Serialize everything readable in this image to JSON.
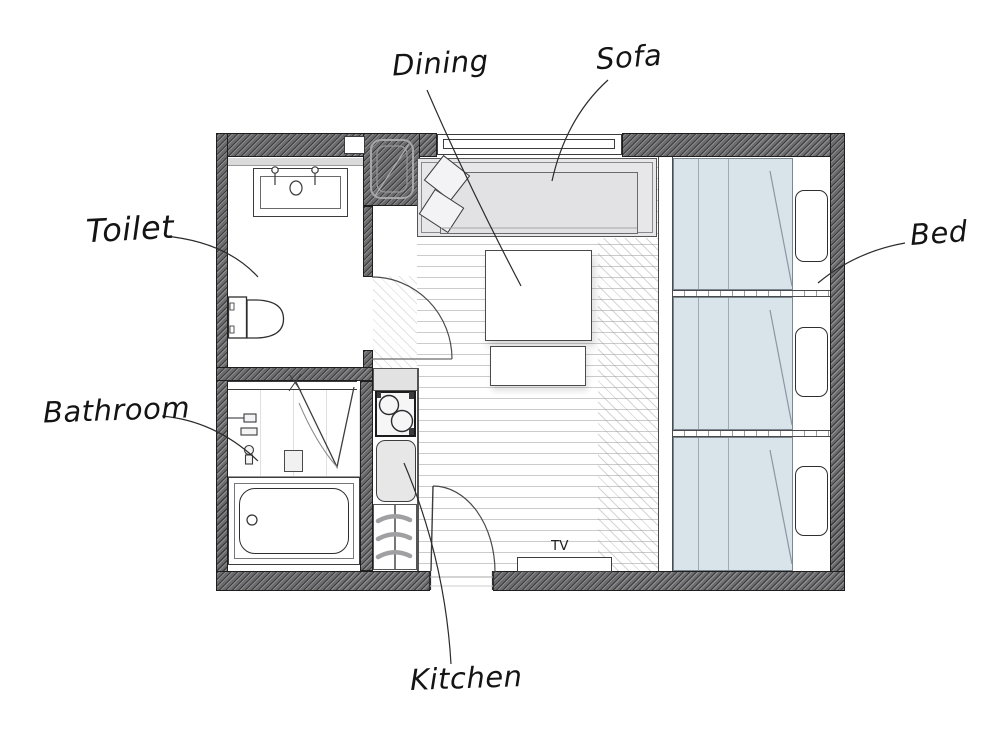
{
  "plan": {
    "type": "floor-plan",
    "labels": {
      "dining": "Dining",
      "sofa": "Sofa",
      "toilet": "Toilet",
      "bed": "Bed",
      "bathroom": "Bathroom",
      "kitchen": "Kitchen",
      "tv": "TV"
    },
    "colors": {
      "wall": "#6b6b6e",
      "ink": "#141414",
      "duvet": "#d9e3ea",
      "duvet_fold": "#9fabb3",
      "sofa": "#e7e7e9",
      "sofa_seat": "#e2e2e4",
      "counter": "#e2e2e3",
      "floor_line": "#cbcbcb",
      "leader": "#2b2b2b"
    }
  }
}
